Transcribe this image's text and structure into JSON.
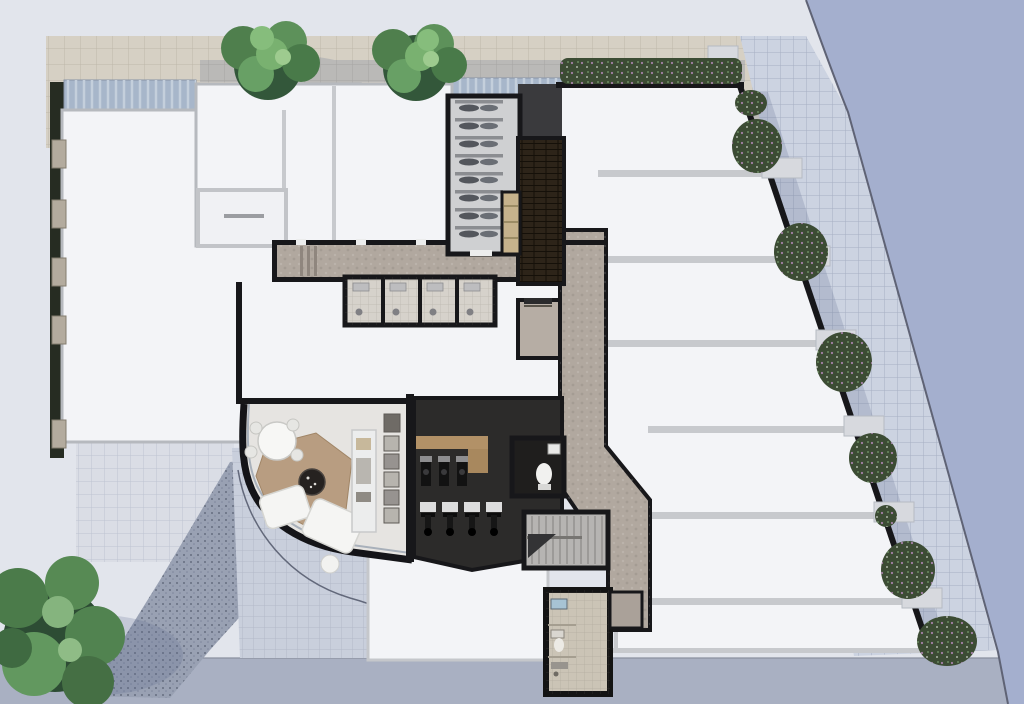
{
  "document": {
    "title": "Ground floor architectural site plan (top-down render)",
    "visible_text": "none",
    "view": "aerial plan view of residential building with streets, sidewalks and landscaping"
  },
  "colors": {
    "sidewalk": "#e2e5ec",
    "paver_tan": "#d6d0c4",
    "paver_right": "#ccd3e1",
    "road_right": "#a4afce",
    "road_bottom": "#a9b0c2",
    "curb": "#5f6375",
    "gravel": "#99a1b3",
    "forecourt": "#c9cfdc",
    "hedge": "#262c22",
    "canopy_glass": "#a7b6ca",
    "floor_white": "#f3f4f7",
    "wall_gray": "#c7c9cd",
    "wall_black": "#17171a",
    "concrete": "#b1a89f",
    "brick_shaft": "#2d2419",
    "pod_tile": "#d6d2cb",
    "bike_room_floor": "#cfd0d2",
    "gym_floor": "#2c2b2a",
    "gym_wood": "#b29167",
    "lobby_floor": "#e6e4e1",
    "rug": "#b89d81",
    "stairs": "#b6b4b2",
    "shower_tile": "#cbc4b6",
    "tree_light": "#79b170",
    "tree_dark": "#33573a",
    "shrub": "#3c4c34",
    "flower": "#b188b4"
  },
  "site": {
    "streets": [
      "street along right edge (beyond curved curb)",
      "street strip along bottom edge"
    ],
    "pavements": [
      "tan paver band across top",
      "light blue-gray sidewalk left",
      "diagonal paver sidewalk right",
      "gravel bed bottom-left",
      "tiled entry forecourt"
    ],
    "planting": {
      "street_trees_top": 2,
      "large_tree_bottom_left": 1,
      "hedge_strip_left": true,
      "flowering_shrub_strip_top_right": true,
      "shrub_beds_along_right_edge": 8
    }
  },
  "building": {
    "rooms": [
      {
        "name": "entrance-lobby",
        "contents": [
          "round table with chairs",
          "area rug",
          "round dark coffee table",
          "two sofas",
          "console shelf",
          "parcel lockers",
          "curved glass facade"
        ]
      },
      {
        "name": "residents-gym",
        "contents": [
          "wood bench",
          "3 cardio machines",
          "4 spin bikes on mats",
          "wc with toilet and basin"
        ]
      },
      {
        "name": "bike-storage",
        "contents": [
          "8 bike rack rows"
        ]
      },
      {
        "name": "service-shaft",
        "contents": [
          "dark brick floor"
        ]
      },
      {
        "name": "corridor-shower-pods",
        "contents": [
          "4 shower pods off main corridor"
        ]
      },
      {
        "name": "elevator",
        "contents": []
      },
      {
        "name": "stair-core",
        "contents": [
          "switchback stair"
        ]
      },
      {
        "name": "ground-shower-room",
        "contents": [
          "basin",
          "toilet",
          "shower"
        ]
      },
      {
        "name": "apartment-plates",
        "contents": [
          "six white unit rows stepping along the street diagonal"
        ]
      },
      {
        "name": "corridors",
        "contents": [
          "concrete finish, L-shaped route to lobby"
        ]
      }
    ],
    "fixture_counts": {
      "bike_rack_rows": 8,
      "gym_spin_bikes": 4,
      "gym_machines": 3,
      "shower_pods": 4,
      "lobby_lockers": 5
    }
  }
}
